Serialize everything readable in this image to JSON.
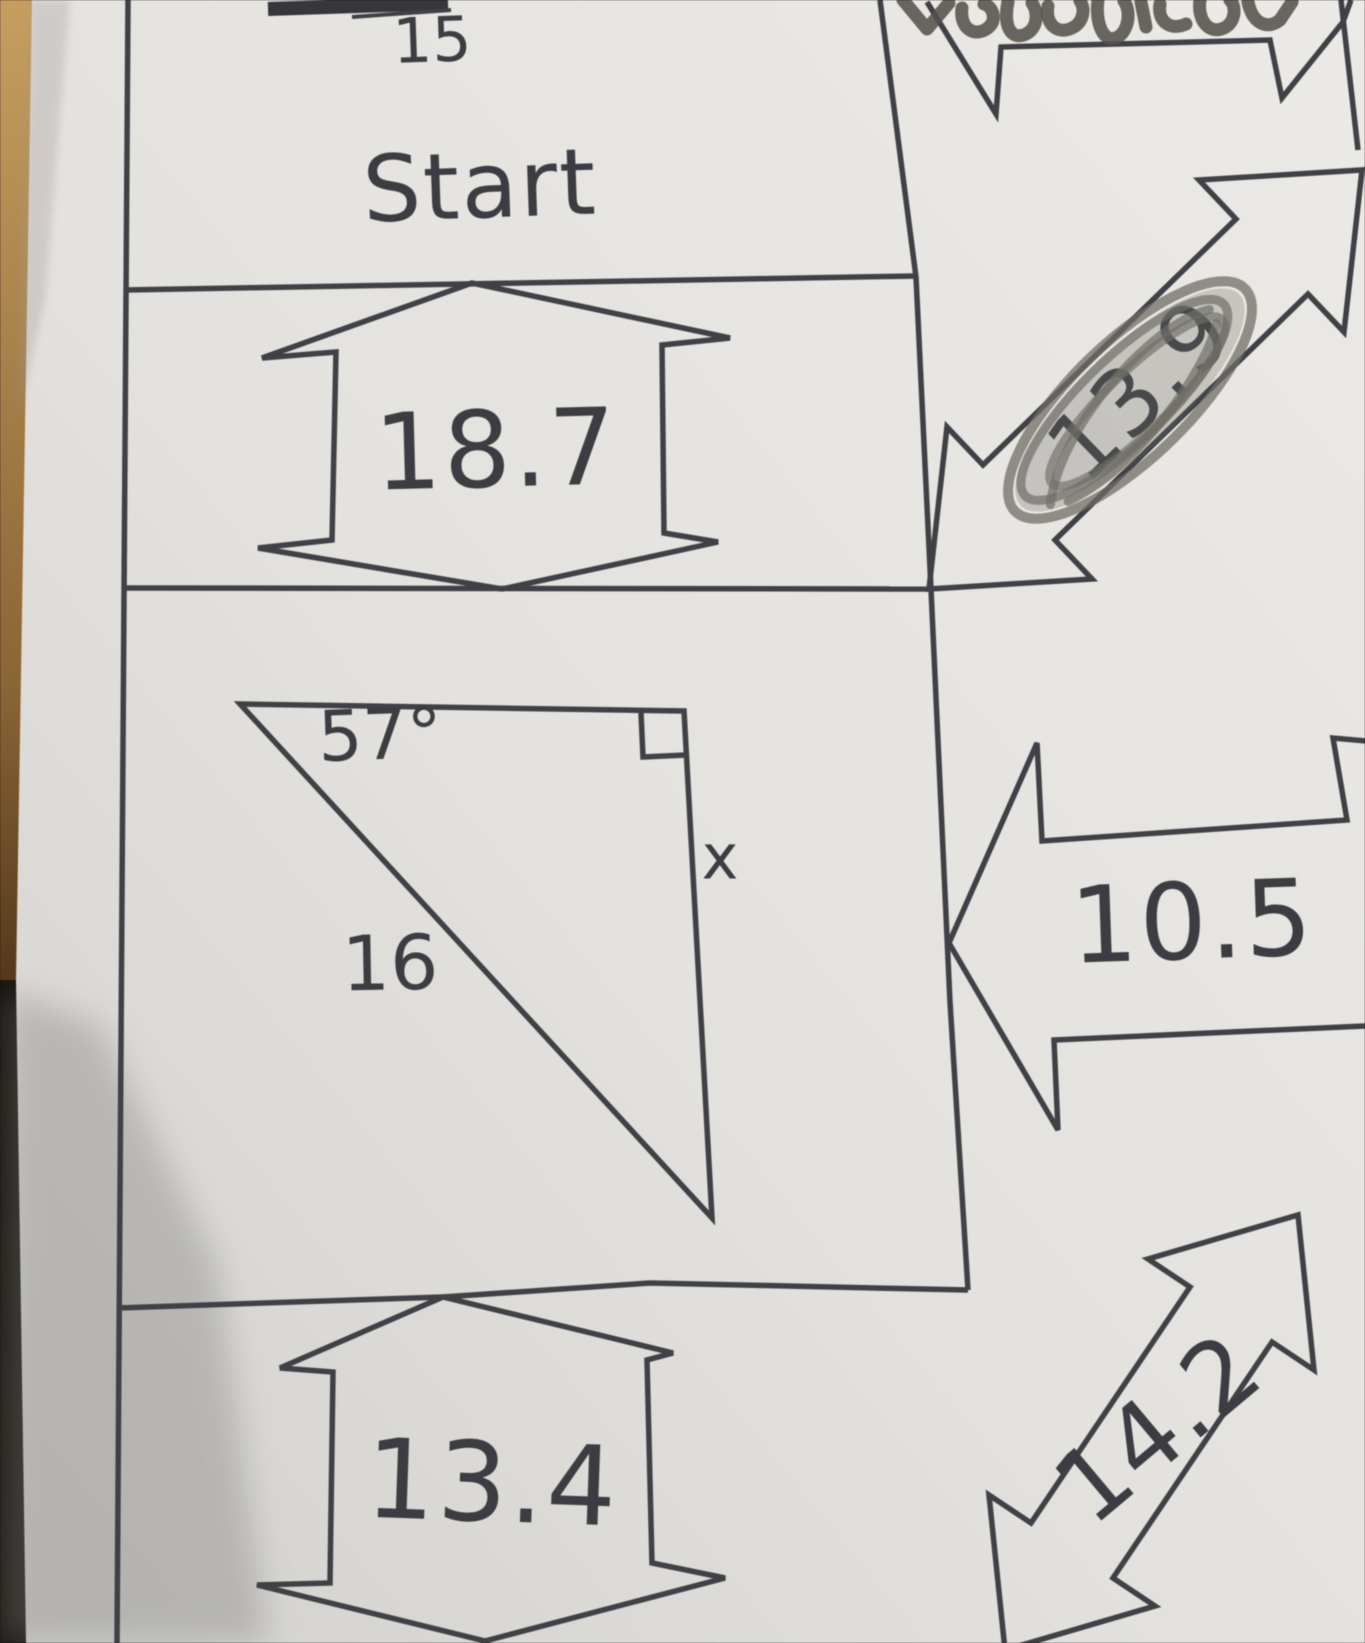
{
  "worksheet": {
    "start_box": {
      "label": "Start"
    },
    "arrow_above_start_value": "15",
    "triangle_problem": {
      "angle_label": "57°",
      "hypotenuse_label": "16",
      "unknown_side_label": "x",
      "has_right_angle_marker": true
    },
    "answer_arrows": [
      {
        "value": "18.7",
        "orientation": "vertical",
        "position": "below-start-box",
        "scribbled_out": false
      },
      {
        "value": "13.9",
        "orientation": "diagonal-up-right",
        "position": "right-of-start-box",
        "scribbled_out": true
      },
      {
        "value": "10.5",
        "orientation": "horizontal",
        "position": "right-of-triangle",
        "scribbled_out": false
      },
      {
        "value": "13.4",
        "orientation": "vertical",
        "position": "below-triangle-box",
        "scribbled_out": false
      },
      {
        "value": "14.2",
        "orientation": "diagonal-up-right",
        "position": "bottom-right",
        "scribbled_out": false
      }
    ],
    "handwriting": {
      "top_note": "illegible pencil writing (cut off at top edge)"
    }
  },
  "colors": {
    "paper": "#e7e5e1",
    "ink": "#3f3f46",
    "pencil": "#54524b",
    "desk_edge": "#bb9159",
    "shadow": "#83827e"
  }
}
